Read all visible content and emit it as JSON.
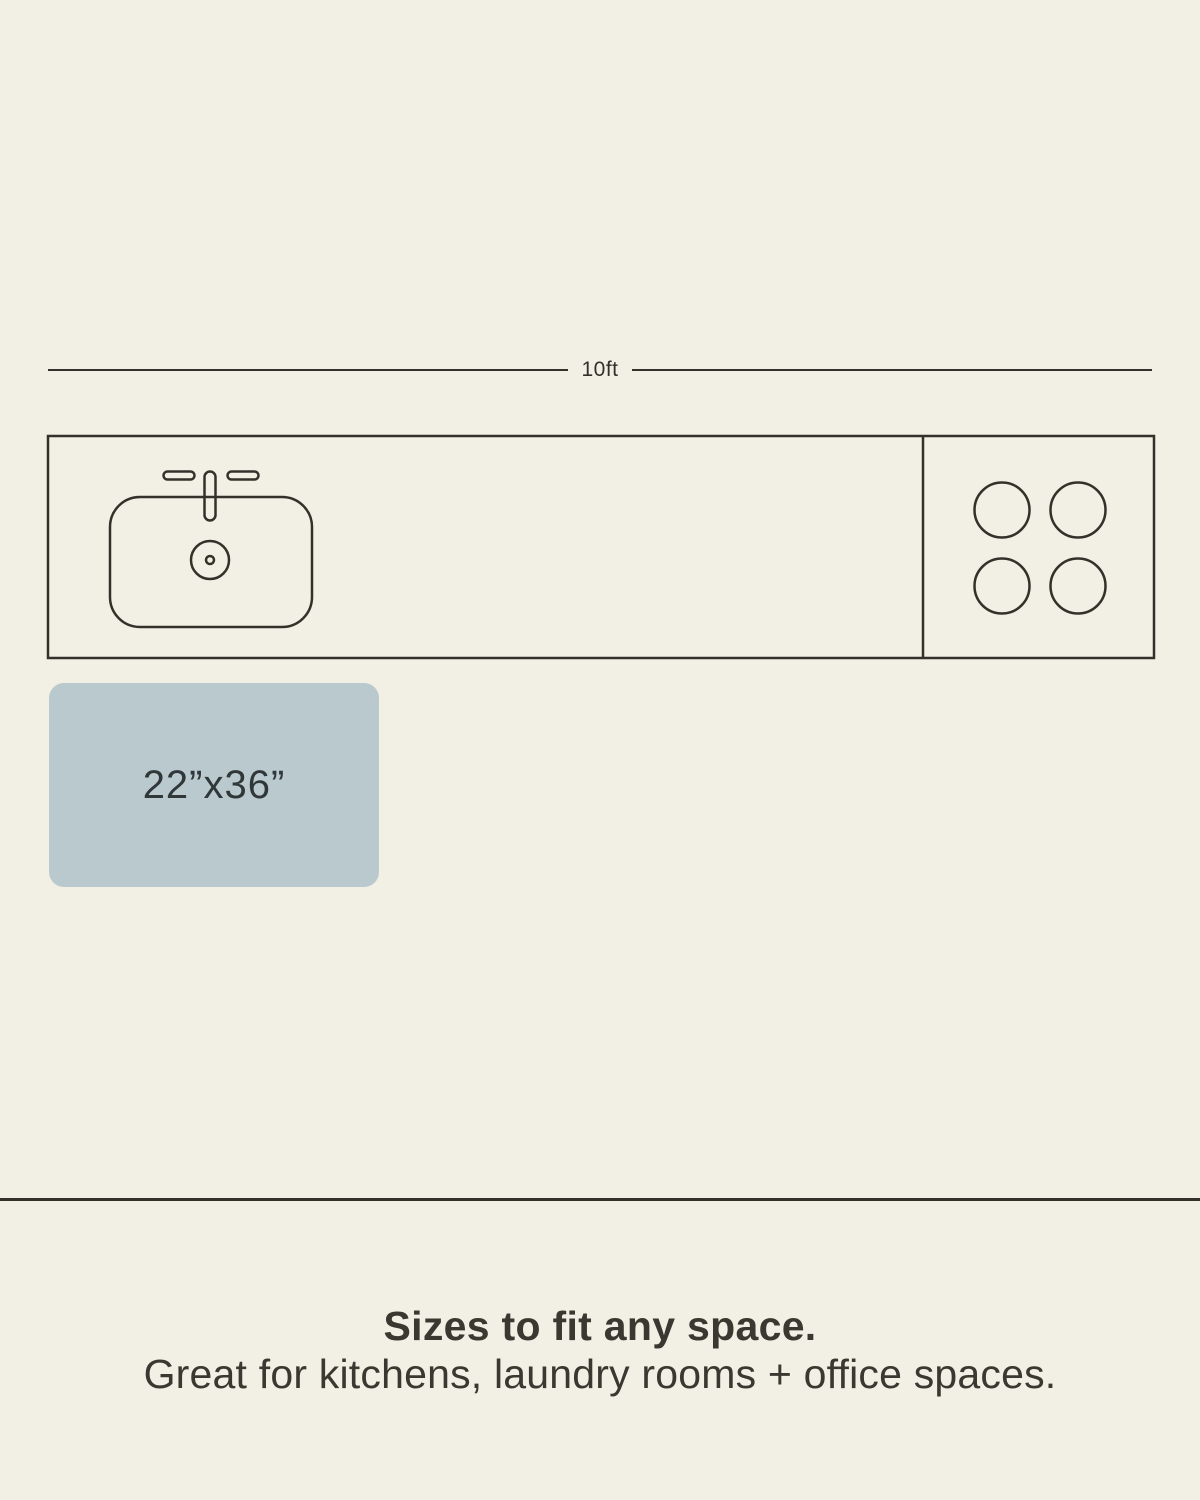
{
  "colors": {
    "background": "#f2efe5",
    "line": "#33312a",
    "caption_text": "#3b3831",
    "mat_fill": "#b9c9ce",
    "mat_text": "#303739"
  },
  "measurement": {
    "label": "10ft"
  },
  "diagram": {
    "description": "top-down kitchen counter outline with sink and four-burner cooktop",
    "icons": {
      "sink": "sink-top-view-icon",
      "faucet": "faucet-icon",
      "drain": "drain-icon",
      "cooktop": "four-burner-cooktop-icon"
    }
  },
  "mat": {
    "size_label": "22”x36”"
  },
  "caption": {
    "title": "Sizes to fit any space.",
    "subtitle": "Great for kitchens, laundry rooms + office spaces."
  }
}
